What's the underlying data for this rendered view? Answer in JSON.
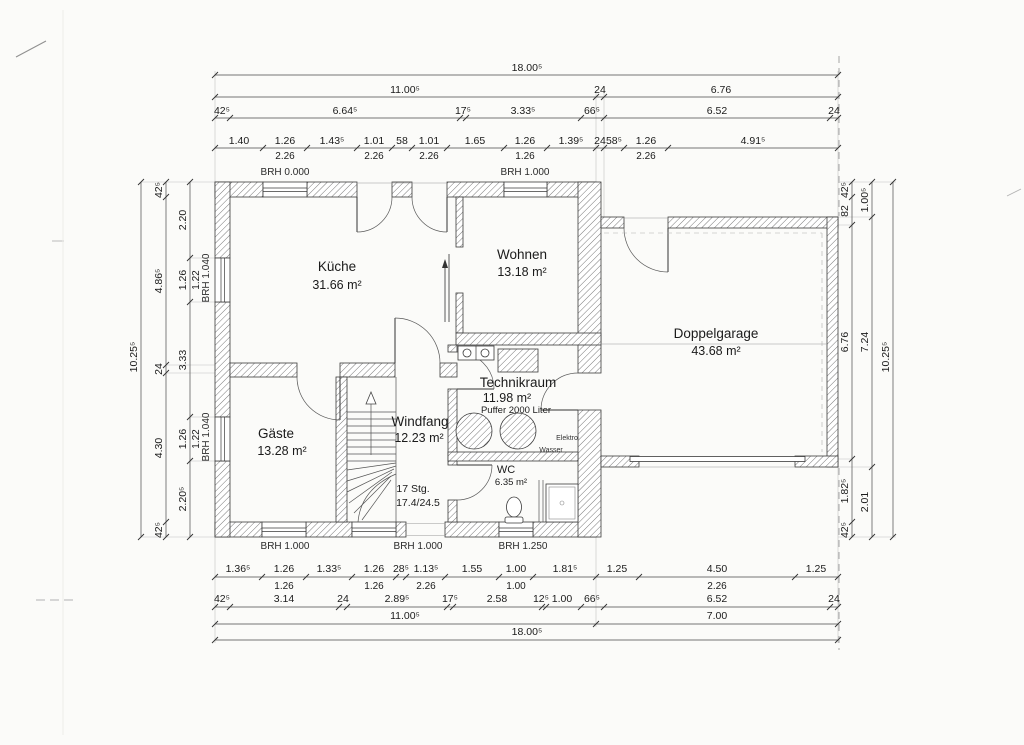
{
  "plan": {
    "rooms": {
      "kueche": {
        "name": "Küche",
        "area": "31.66 m²"
      },
      "wohnen": {
        "name": "Wohnen",
        "area": "13.18 m²"
      },
      "doppelgarage": {
        "name": "Doppelgarage",
        "area": "43.68 m²"
      },
      "technikraum": {
        "name": "Technikraum",
        "area": "11.98 m²",
        "note": "Puffer 2000 Liter"
      },
      "windfang": {
        "name": "Windfang",
        "area": "12.23 m²"
      },
      "gaeste": {
        "name": "Gäste",
        "area": "13.28 m²"
      },
      "wc": {
        "name": "WC",
        "area": "6.35 m²"
      }
    },
    "stairs": {
      "count": "17 Stg.",
      "ratio": "17.4/24.5"
    },
    "utility": {
      "elektro": "Elektro",
      "wasser": "Wasser"
    },
    "brh": {
      "top": [
        "BRH 0.000",
        "BRH 1.000"
      ],
      "left": [
        "BRH 1.040",
        "BRH 1.040"
      ],
      "bottom": [
        "BRH 1.000",
        "BRH 1.000",
        "BRH 1.250"
      ]
    }
  },
  "dims": {
    "top": {
      "total": "18.00⁵",
      "row2": [
        "11.00⁵",
        "24",
        "6.76"
      ],
      "row3": [
        "42⁵",
        "6.64⁵",
        "17⁵",
        "3.33⁵",
        "66⁵",
        "6.52",
        "24"
      ],
      "row4": [
        "1.40",
        "1.26",
        "1.43⁵",
        "1.01",
        "58",
        "1.01",
        "1.65",
        "1.26",
        "1.39⁵",
        "24",
        "58⁵",
        "1.26",
        "4.91⁵"
      ],
      "row5": [
        "2.26",
        "2.26",
        "2.26",
        "1.26",
        "2.26"
      ]
    },
    "bottom": {
      "row1": [
        "1.36⁵",
        "1.26",
        "1.33⁵",
        "1.26",
        "28⁵",
        "1.13⁵",
        "1.55",
        "1.00",
        "1.81⁵",
        "1.25",
        "4.50",
        "1.25"
      ],
      "row2": [
        "1.26",
        "1.26",
        "2.26",
        "1.00",
        "2.26"
      ],
      "row3": [
        "42⁵",
        "3.14",
        "24",
        "2.89⁵",
        "17⁵",
        "2.58",
        "12⁵",
        "1.00",
        "66⁵",
        "6.52",
        "24"
      ],
      "row4": [
        "11.00⁵",
        "7.00"
      ],
      "total": "18.00⁵"
    },
    "left": {
      "total": "10.25⁵",
      "row2": [
        "42⁵",
        "4.86⁵",
        "24",
        "4.30",
        "42⁵"
      ],
      "row3": [
        "2.20",
        "1.26",
        "3.33",
        "1.26",
        "2.20⁵"
      ],
      "row4": [
        "1.22",
        "1.22"
      ]
    },
    "right": {
      "row1": [
        "42⁵",
        "82",
        "6.76",
        "1.82⁵",
        "42⁵"
      ],
      "row2": [
        "1.00⁵",
        "7.24",
        "2.01"
      ],
      "total": "10.25⁵"
    }
  }
}
